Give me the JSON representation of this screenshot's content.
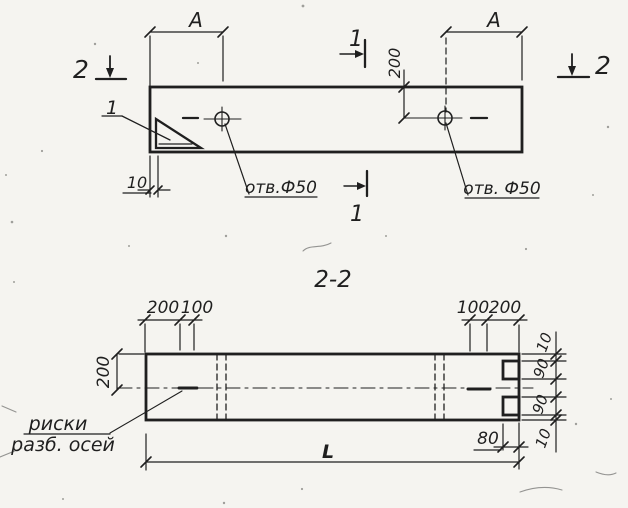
{
  "colors": {
    "paper": "#f5f4f0",
    "ink": "#1f1f1f"
  },
  "top_view": {
    "dim_a_left": "A",
    "dim_a_right": "A",
    "section2_left": "2",
    "section2_right": "2",
    "section1_top": "1",
    "section1_bottom": "1",
    "dim_200": "200",
    "dim_10": "10",
    "corner_detail": "1",
    "hole_label_left": "отв.Ф50",
    "hole_label_right": "отв. Ф50"
  },
  "section_view": {
    "title": "2-2",
    "dim_top_left_200": "200",
    "dim_top_left_100": "100",
    "dim_top_right_100": "100",
    "dim_top_right_200": "200",
    "dim_side_200": "200",
    "note_line1": "риски",
    "note_line2": "разб. осей",
    "dim_right_10_top": "10",
    "dim_right_90_top": "90",
    "dim_right_90_bottom": "90",
    "dim_right_10_bottom": "10",
    "dim_80": "80",
    "dim_length": "L"
  }
}
